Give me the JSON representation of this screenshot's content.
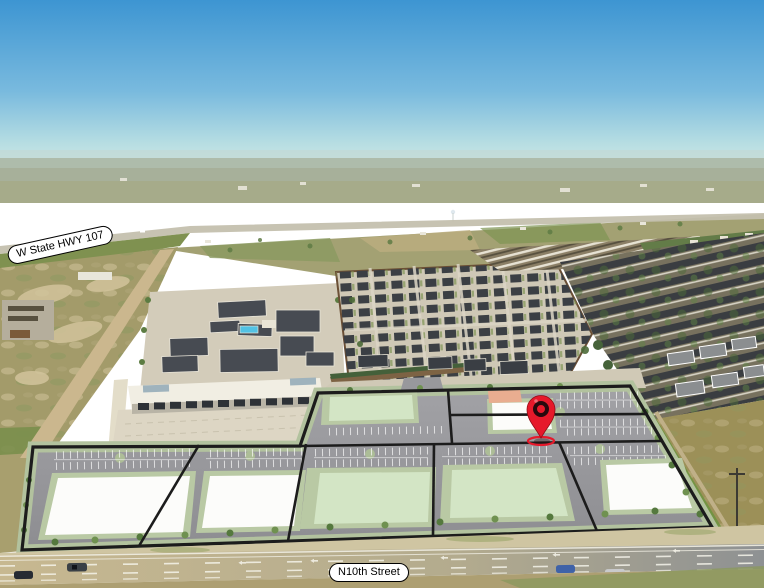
{
  "scene": {
    "type": "aerial-drone-photo-with-site-plan-overlay",
    "labels": {
      "highway": "W State HWY 107",
      "street": "N10th Street"
    },
    "marker": {
      "name": "location-pin",
      "color": "#e6192b",
      "ring_color": "#27090d"
    },
    "colors": {
      "sky_top": "#3d95d2",
      "sky_horizon": "#cfe9e5",
      "site_asphalt": "#98989c",
      "parcel_border": "#1c1c1c",
      "landscape_green": "#b2c29e",
      "pad_white": "#fcfcfa",
      "pad_green": "#d3e5c5",
      "pad_salmon": "#e9ad90",
      "road_concrete": "#c7b890",
      "label_background": "#ffffff",
      "label_text": "#000000"
    }
  }
}
